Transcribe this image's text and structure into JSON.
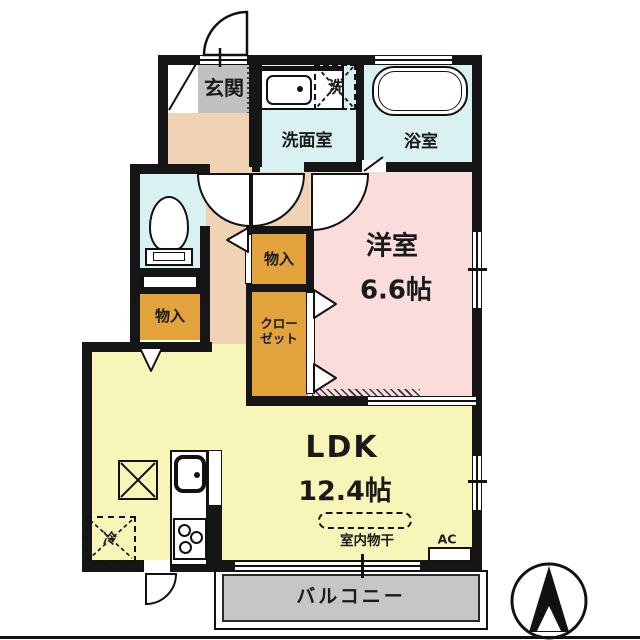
{
  "palette": {
    "wall": "#161616",
    "line": "#111111",
    "hallway": "#f0d2b4",
    "room_pink": "#fadcdb",
    "ldk_yellow": "#f8f5b8",
    "wet_cyan": "#d9f1f1",
    "genkan_gray": "#c2c1c1",
    "balcony_gray": "#c7c6c6",
    "storage_orange": "#e2a33c",
    "text": "#1a1a1a"
  },
  "rooms": {
    "genkan": {
      "label": "玄関"
    },
    "washroom": {
      "label": "洗面室"
    },
    "bathroom": {
      "label": "浴室"
    },
    "laundry_machine": {
      "label": "洗"
    },
    "storage_left": {
      "label": "物入"
    },
    "storage_center": {
      "label": "物入"
    },
    "closet": {
      "label_line1": "クロー",
      "label_line2": "ゼット"
    },
    "western_room": {
      "label": "洋室",
      "size": "6.6帖"
    },
    "ldk": {
      "label": "LDK",
      "size": "12.4帖"
    },
    "balcony": {
      "label": "バルコニー"
    },
    "refrigerator": {
      "label": "冷"
    }
  },
  "annotations": {
    "indoor_drying": {
      "label": "室内物干"
    },
    "air_conditioner": {
      "label": "AC"
    }
  }
}
